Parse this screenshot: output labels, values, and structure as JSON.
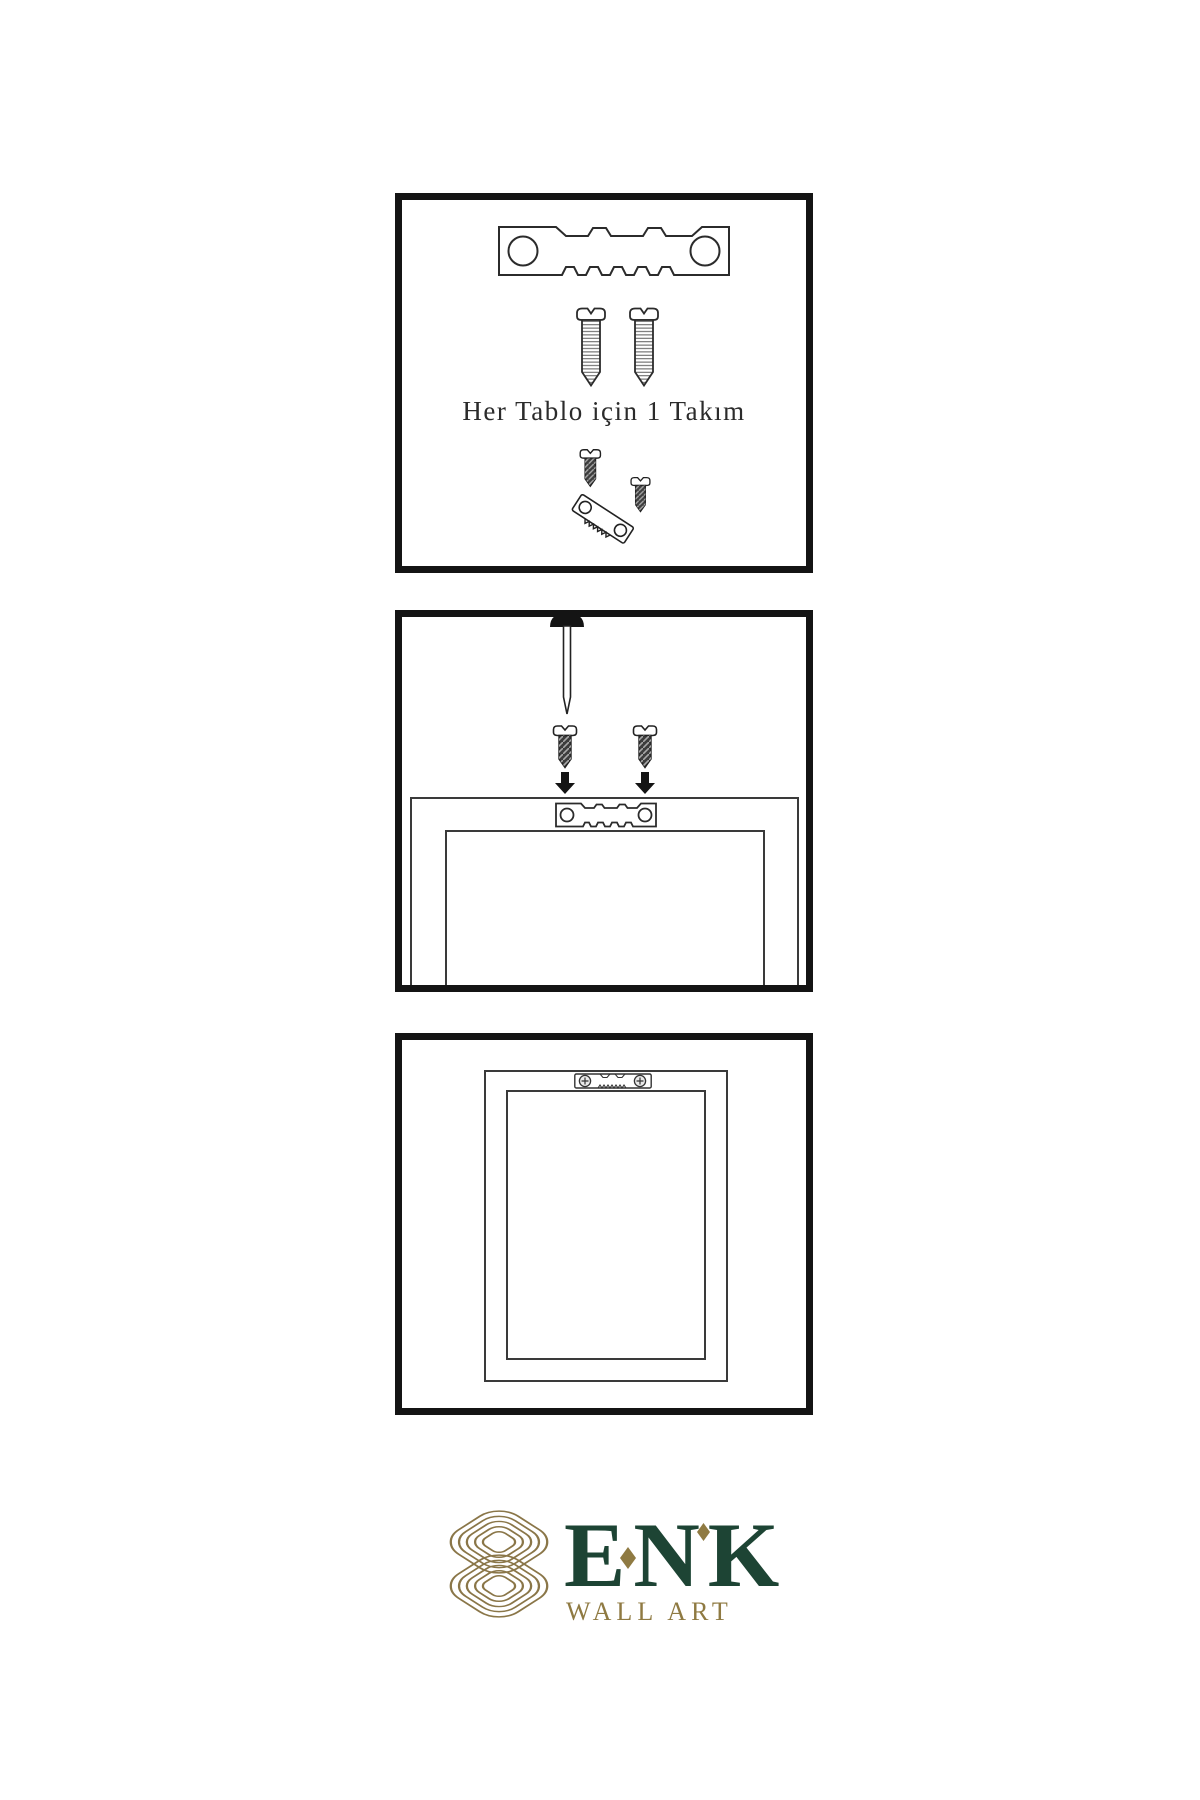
{
  "page": {
    "background_color": "#ffffff",
    "type": "product-instruction-sheet"
  },
  "instructions": {
    "panel1": {
      "caption": "Her Tablo için 1 Takım",
      "icons": [
        "sawtooth-hanger-icon",
        "screw-icon",
        "screw-icon",
        "screw-into-hanger-icon"
      ]
    },
    "panel2": {
      "icons": [
        "wall-nail-icon",
        "dark-screw-icon",
        "dark-screw-icon",
        "down-arrow-icon",
        "down-arrow-icon",
        "frame-back-outline",
        "sawtooth-hanger-icon"
      ]
    },
    "panel3": {
      "icons": [
        "frame-back-outline",
        "mounted-sawtooth-hanger-icon"
      ]
    }
  },
  "brand": {
    "name": "ENK",
    "subtitle": "WALL ART",
    "logo": "interlocked-knot-logo",
    "colors": {
      "green": "#1d4434",
      "gold": "#8f7a42",
      "knot_gold": "#8a7648"
    }
  },
  "colors": {
    "panel_border": "#141414",
    "line_art": "#2b2b2b",
    "caption_text": "#2b2b2b"
  }
}
